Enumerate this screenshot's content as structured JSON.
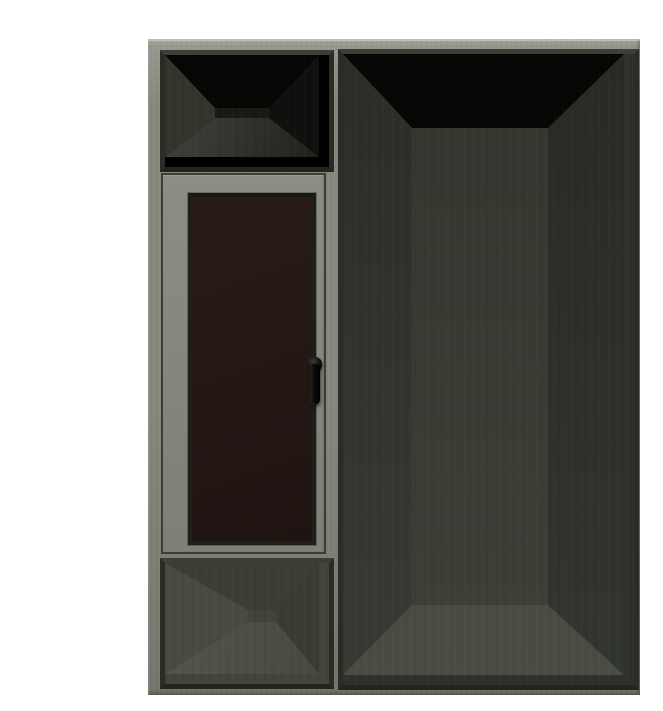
{
  "scene": {
    "description": "3D product render of a grey-green aluminium window and door frame combination unit on a plain white background",
    "background_color": "#ffffff"
  },
  "unit": {
    "name": "aluminium-frame-unit",
    "left_column_parts": [
      "open-transom-window",
      "glazed-sash-with-black-handle",
      "open-bottom-section"
    ],
    "right_column_parts": [
      "full-height-open-door-frame"
    ],
    "handle_side": "right-of-glazed-sash"
  },
  "colors": {
    "page_bg": "#ffffff",
    "frame_face": "#84877c",
    "frame_face_light": "#989b90",
    "frame_face_dark": "#72756a",
    "frame_edge_highlight": "#aeb1a6",
    "lining_top": "#3c3f37",
    "lining_side": "#2a2d26",
    "lining_dark": "#22251e",
    "sash_face": "#878a7f",
    "sash_gap": "#3b3e35",
    "bead": "#1d1f1b",
    "glass": "#241815",
    "handle": "#0d0d0d",
    "void_black": "#060605",
    "transom_floor_light": "#454840",
    "transom_floor_dark": "#1d1f1a",
    "transom_reveal_left": "#32352c",
    "transom_reveal_right": "#0f110e",
    "transom_back": "#181a16",
    "bottom_base": "#42453c",
    "bottom_top": "#3b3e35",
    "bottom_left": "#484b41",
    "bottom_right": "#393c33",
    "bottom_back": "#41443b",
    "bottom_floor_light": "#53564c",
    "bottom_floor_dark": "#46493f",
    "door_side_top": "#2b2e27",
    "door_side_bottom": "#383b33",
    "door_back_top": "#33362e",
    "door_back_bottom": "#3e4138",
    "door_floor_top": "#3f423a",
    "door_floor_bottom": "#4a4d44"
  }
}
